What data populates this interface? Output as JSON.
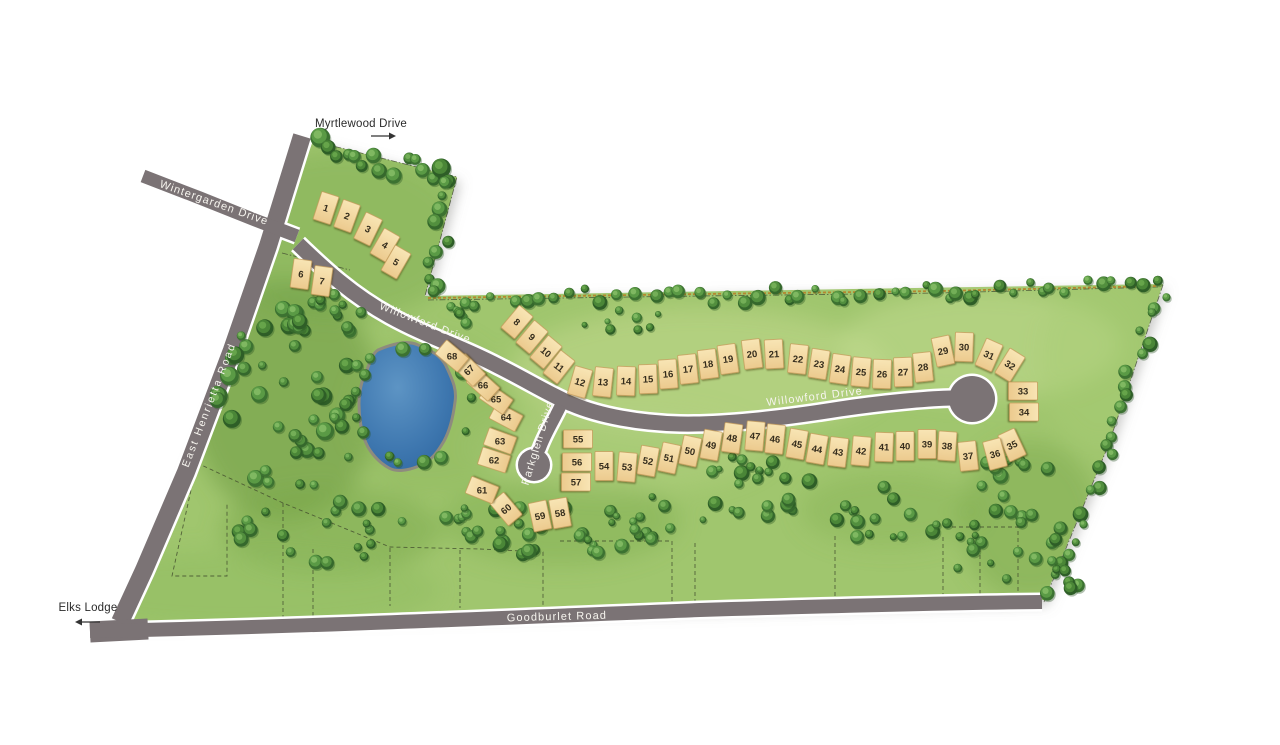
{
  "labels": {
    "myrtlewood": "Myrtlewood Drive",
    "wintergarden": "Wintergarden Drive",
    "willowford": "Willowford Drive",
    "east_henrietta": "East Henrietta Road",
    "parkglen": "Parkglen Drive",
    "goodburlet": "Goodburlet Road",
    "elks_lodge": "Elks Lodge"
  },
  "colors": {
    "grass": "#a0c66e",
    "road": "#7b7375",
    "road_casing": "#ffffff",
    "lot_fill": "#f5dda6",
    "lot_border": "#c49a58",
    "lot_number_text": "#352d1d",
    "pond": "#3f78b0",
    "tree_green": "#4f8c3a",
    "fence": "#b5872f",
    "dark_label": "#2a2a2a",
    "light_label": "#f6f4ee"
  },
  "lots": [
    {
      "n": "1",
      "x": 326,
      "y": 208,
      "rot": 18
    },
    {
      "n": "2",
      "x": 347,
      "y": 216,
      "rot": 20
    },
    {
      "n": "3",
      "x": 368,
      "y": 229,
      "rot": 26
    },
    {
      "n": "4",
      "x": 385,
      "y": 245,
      "rot": 30
    },
    {
      "n": "5",
      "x": 396,
      "y": 262,
      "rot": 30
    },
    {
      "n": "6",
      "x": 301,
      "y": 274,
      "rot": 8
    },
    {
      "n": "7",
      "x": 322,
      "y": 281,
      "rot": 8
    },
    {
      "n": "8",
      "x": 517,
      "y": 322,
      "rot": 40
    },
    {
      "n": "9",
      "x": 532,
      "y": 337,
      "rot": 40
    },
    {
      "n": "10",
      "x": 546,
      "y": 352,
      "rot": 40
    },
    {
      "n": "11",
      "x": 559,
      "y": 367,
      "rot": 38
    },
    {
      "n": "12",
      "x": 580,
      "y": 382,
      "rot": 16
    },
    {
      "n": "13",
      "x": 603,
      "y": 382,
      "rot": 6
    },
    {
      "n": "14",
      "x": 626,
      "y": 381,
      "rot": 2
    },
    {
      "n": "15",
      "x": 648,
      "y": 379,
      "rot": -2
    },
    {
      "n": "16",
      "x": 668,
      "y": 374,
      "rot": -4
    },
    {
      "n": "17",
      "x": 688,
      "y": 369,
      "rot": -6
    },
    {
      "n": "18",
      "x": 708,
      "y": 364,
      "rot": -7
    },
    {
      "n": "19",
      "x": 728,
      "y": 359,
      "rot": -8
    },
    {
      "n": "20",
      "x": 752,
      "y": 354,
      "rot": -7
    },
    {
      "n": "21",
      "x": 774,
      "y": 354,
      "rot": -3
    },
    {
      "n": "22",
      "x": 798,
      "y": 359,
      "rot": 6
    },
    {
      "n": "23",
      "x": 819,
      "y": 364,
      "rot": 9
    },
    {
      "n": "24",
      "x": 840,
      "y": 369,
      "rot": 8
    },
    {
      "n": "25",
      "x": 861,
      "y": 372,
      "rot": 5
    },
    {
      "n": "26",
      "x": 882,
      "y": 374,
      "rot": 2
    },
    {
      "n": "27",
      "x": 903,
      "y": 372,
      "rot": -2
    },
    {
      "n": "28",
      "x": 923,
      "y": 367,
      "rot": -6
    },
    {
      "n": "29",
      "x": 943,
      "y": 351,
      "rot": -12
    },
    {
      "n": "30",
      "x": 964,
      "y": 347,
      "rot": 2
    },
    {
      "n": "31",
      "x": 989,
      "y": 355,
      "rot": 24
    },
    {
      "n": "32",
      "x": 1010,
      "y": 365,
      "rot": 32
    },
    {
      "n": "33",
      "x": 1023,
      "y": 391,
      "rot": 90
    },
    {
      "n": "34",
      "x": 1024,
      "y": 412,
      "rot": 90
    },
    {
      "n": "35",
      "x": 1012,
      "y": 445,
      "rot": -25
    },
    {
      "n": "36",
      "x": 995,
      "y": 454,
      "rot": -15
    },
    {
      "n": "37",
      "x": 968,
      "y": 456,
      "rot": -6
    },
    {
      "n": "38",
      "x": 947,
      "y": 446,
      "rot": 4
    },
    {
      "n": "39",
      "x": 927,
      "y": 444,
      "rot": 0
    },
    {
      "n": "40",
      "x": 905,
      "y": 446,
      "rot": 0
    },
    {
      "n": "41",
      "x": 884,
      "y": 447,
      "rot": 2
    },
    {
      "n": "42",
      "x": 861,
      "y": 451,
      "rot": 5
    },
    {
      "n": "43",
      "x": 838,
      "y": 452,
      "rot": 7
    },
    {
      "n": "44",
      "x": 817,
      "y": 449,
      "rot": 10
    },
    {
      "n": "45",
      "x": 797,
      "y": 444,
      "rot": 10
    },
    {
      "n": "46",
      "x": 775,
      "y": 439,
      "rot": 6
    },
    {
      "n": "47",
      "x": 755,
      "y": 436,
      "rot": 5
    },
    {
      "n": "48",
      "x": 732,
      "y": 438,
      "rot": 8
    },
    {
      "n": "49",
      "x": 711,
      "y": 445,
      "rot": 10
    },
    {
      "n": "50",
      "x": 690,
      "y": 451,
      "rot": 12
    },
    {
      "n": "51",
      "x": 669,
      "y": 458,
      "rot": 12
    },
    {
      "n": "52",
      "x": 648,
      "y": 461,
      "rot": 10
    },
    {
      "n": "53",
      "x": 627,
      "y": 467,
      "rot": 5
    },
    {
      "n": "54",
      "x": 604,
      "y": 466,
      "rot": 0
    },
    {
      "n": "55",
      "x": 578,
      "y": 439,
      "rot": 90
    },
    {
      "n": "56",
      "x": 577,
      "y": 462,
      "rot": 90
    },
    {
      "n": "57",
      "x": 576,
      "y": 482,
      "rot": 90
    },
    {
      "n": "58",
      "x": 560,
      "y": 513,
      "rot": -10
    },
    {
      "n": "59",
      "x": 540,
      "y": 516,
      "rot": -12
    },
    {
      "n": "60",
      "x": 506,
      "y": 509,
      "rot": -40
    },
    {
      "n": "61",
      "x": 482,
      "y": 490,
      "rot": -68
    },
    {
      "n": "62",
      "x": 494,
      "y": 460,
      "rot": -72
    },
    {
      "n": "63",
      "x": 500,
      "y": 441,
      "rot": -70
    },
    {
      "n": "64",
      "x": 506,
      "y": 417,
      "rot": -62
    },
    {
      "n": "65",
      "x": 496,
      "y": 399,
      "rot": -55
    },
    {
      "n": "66",
      "x": 483,
      "y": 385,
      "rot": -48
    },
    {
      "n": "67",
      "x": 469,
      "y": 370,
      "rot": -45
    },
    {
      "n": "68",
      "x": 452,
      "y": 356,
      "rot": -50
    }
  ]
}
